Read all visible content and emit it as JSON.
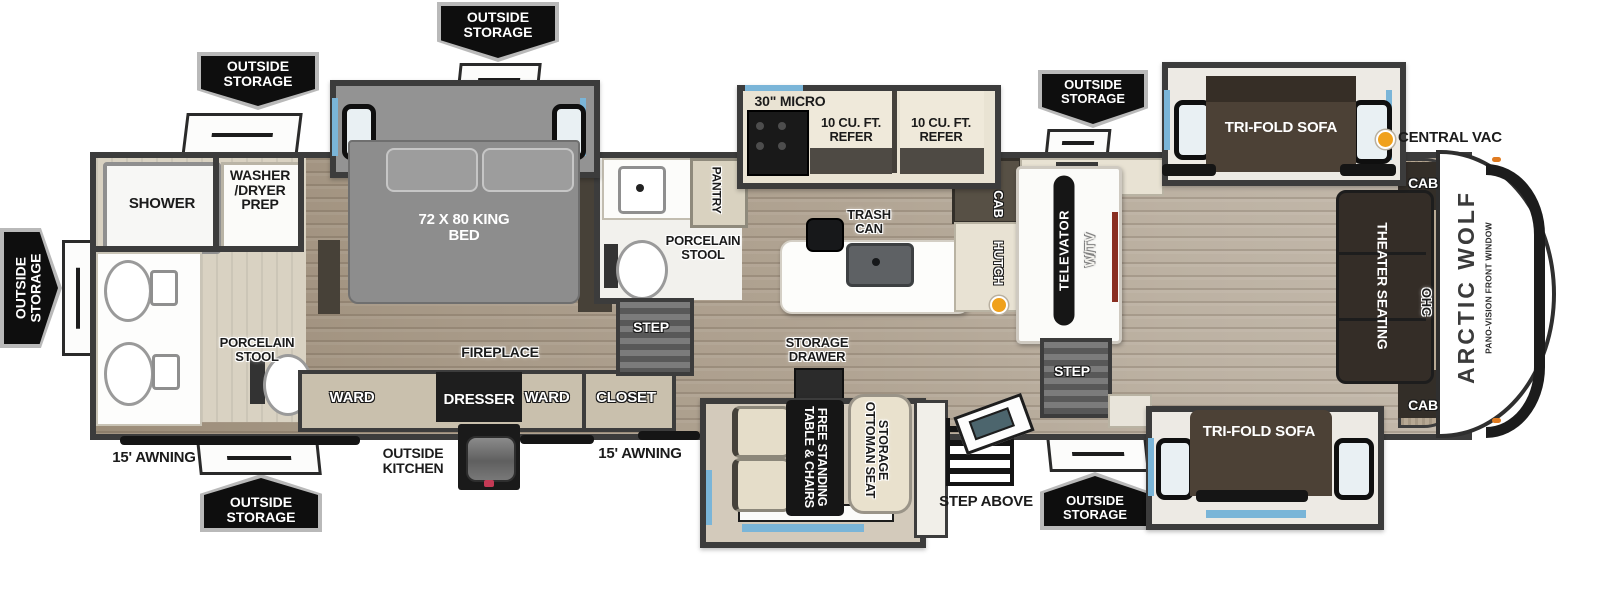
{
  "title": "Arctic Wolf Fifth Wheel Floorplan",
  "colors": {
    "accent_blue": "#7ab5d8",
    "pennant_bg": "#0e0e0e",
    "vac_dot_orange": "#f0a11c"
  },
  "callouts": {
    "outside_storage": "OUTSIDE STORAGE",
    "central_vac": "CENTRAL VAC",
    "awning": "15' AWNING",
    "outside_kitchen": "OUTSIDE KITCHEN",
    "step_above": "STEP ABOVE"
  },
  "rear_bath": {
    "shower": "SHOWER",
    "washer_dryer_prep": "WASHER /DRYER PREP",
    "porcelain_stool": "PORCELAIN STOOL"
  },
  "bedroom": {
    "king_bed": "72 X 80 KING BED",
    "ward": "WARD",
    "dresser": "DRESSER",
    "fireplace": "FIREPLACE",
    "closet": "CLOSET"
  },
  "mid_bath": {
    "pantry": "PANTRY",
    "porcelain_stool": "PORCELAIN STOOL",
    "step": "STEP"
  },
  "kitchen": {
    "micro": "30\" MICRO",
    "refer": "10 CU. FT. REFER",
    "trash_can": "TRASH CAN",
    "storage_drawer": "STORAGE DRAWER",
    "cab": "CAB",
    "hutch": "HUTCH"
  },
  "dinette": {
    "table": "FREE STANDING TABLE & CHAIRS",
    "ottoman": "STORAGE OTTOMAN SEAT"
  },
  "living": {
    "televator": "TELEVATOR",
    "w_tv": "W/TV",
    "step": "STEP",
    "tri_fold_sofa": "TRI-FOLD SOFA",
    "theater_seating": "THEATER SEATING",
    "ohc": "OHC",
    "cab": "CAB"
  },
  "front": {
    "brand": "ARCTIC WOLF",
    "pano_window": "PANO-VISION FRONT WINDOW"
  }
}
